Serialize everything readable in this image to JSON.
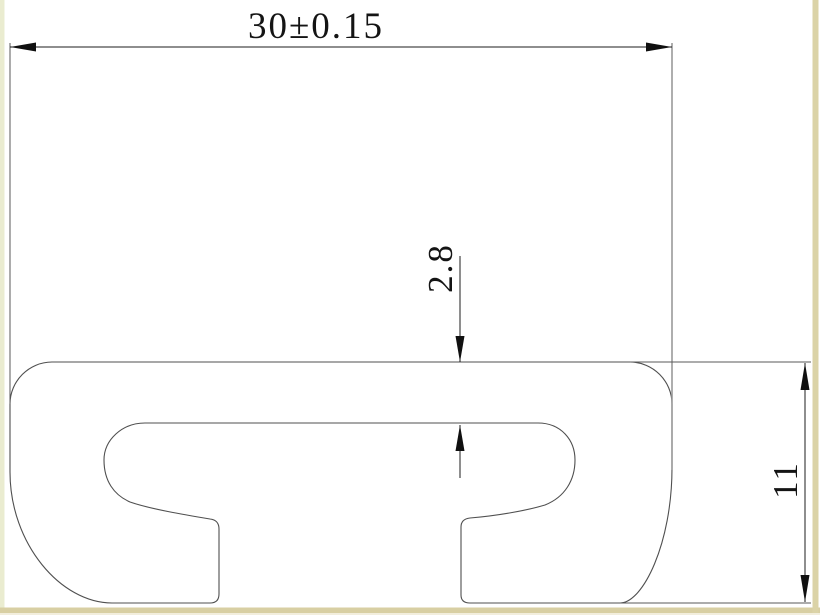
{
  "drawing": {
    "type": "profile-cross-section",
    "dimensions": {
      "overall_width": {
        "label": "30±0.15",
        "value": 30,
        "tolerance": 0.15,
        "orientation": "horizontal"
      },
      "top_wall_thickness": {
        "label": "2.8",
        "value": 2.8,
        "orientation": "vertical"
      },
      "overall_height": {
        "label": "11",
        "value": 11,
        "orientation": "vertical"
      }
    }
  },
  "colors": {
    "background": "#ffffff",
    "profile_outline": "#4f4f4f",
    "dimension_line": "#1c1c1c",
    "extension_line": "#9a9a9a",
    "text": "#141414",
    "border_left_band": "#eaecd0",
    "border_bottom_band": "#d8cfa3",
    "border_right_band": "#dbd3a7",
    "border_bottom_edge": "#f2eedd"
  }
}
